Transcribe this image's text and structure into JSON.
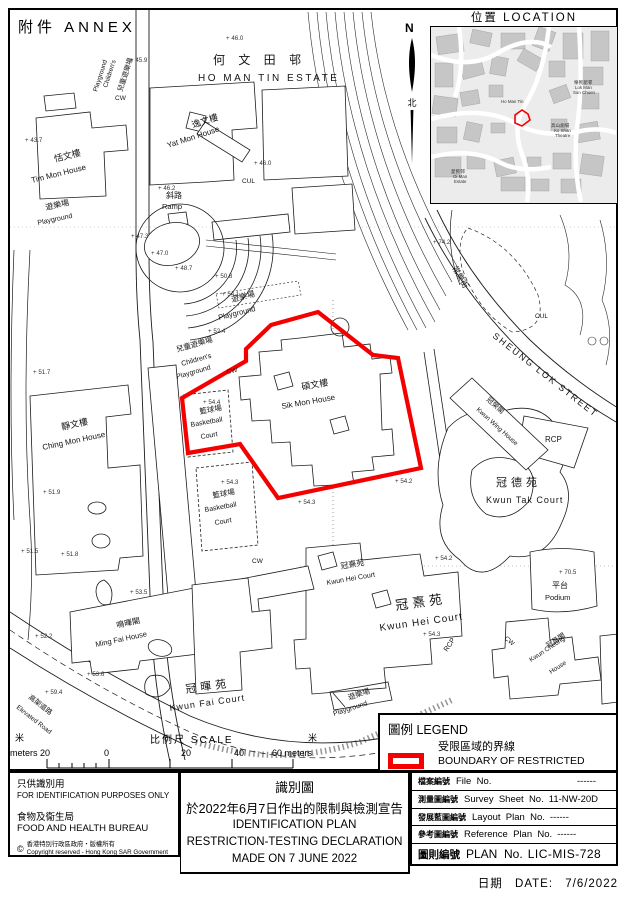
{
  "annex_label": "附件  ANNEX",
  "north": {
    "n": "N",
    "zh": "北"
  },
  "location_inset": {
    "title": "位置  LOCATION",
    "labels": [
      {
        "t": "樂民新邨",
        "x": 143,
        "y": 57,
        "s": 4.6
      },
      {
        "t": "Lok Man",
        "x": 144,
        "y": 62,
        "s": 4.4
      },
      {
        "t": "Sun Chuen",
        "x": 142,
        "y": 67,
        "s": 4.4
      },
      {
        "t": "Ho Man Tin",
        "x": 70,
        "y": 76,
        "s": 4.4
      },
      {
        "t": "高山劇場",
        "x": 120,
        "y": 100,
        "s": 4.6
      },
      {
        "t": "Ko Shan",
        "x": 123,
        "y": 105,
        "s": 4.4
      },
      {
        "t": "Theatre",
        "x": 124,
        "y": 110,
        "s": 4.4
      },
      {
        "t": "愛民邨",
        "x": 20,
        "y": 146,
        "s": 4.6
      },
      {
        "t": "Oi Man",
        "x": 22,
        "y": 151,
        "s": 4.4
      },
      {
        "t": "Estate",
        "x": 23,
        "y": 156,
        "s": 4.4
      }
    ]
  },
  "map": {
    "labels": [
      {
        "t": "何 文 田 邨",
        "x": 213,
        "y": 64,
        "s": 12,
        "ls": 5
      },
      {
        "t": "HO MAN TIN ESTATE",
        "x": 198,
        "y": 81,
        "s": 10,
        "ls": 2.5
      },
      {
        "t": "兒童遊樂場",
        "x": 122,
        "y": 92,
        "r": -72,
        "s": 7
      },
      {
        "t": "Children's",
        "x": 107,
        "y": 88,
        "r": -72,
        "s": 6.5
      },
      {
        "t": "Playground",
        "x": 97,
        "y": 92,
        "r": -72,
        "s": 6.5
      },
      {
        "t": "逸文樓",
        "x": 193,
        "y": 128,
        "r": -18,
        "s": 9
      },
      {
        "t": "Yat Mon House",
        "x": 168,
        "y": 148,
        "r": -18,
        "s": 8
      },
      {
        "t": "恬文樓",
        "x": 55,
        "y": 162,
        "r": -14,
        "s": 9
      },
      {
        "t": "Tim Mon House",
        "x": 32,
        "y": 183,
        "r": -14,
        "s": 8
      },
      {
        "t": "斜路",
        "x": 166,
        "y": 198,
        "s": 8
      },
      {
        "t": "Ramp",
        "x": 162,
        "y": 209,
        "s": 7.5
      },
      {
        "t": "遊樂場",
        "x": 46,
        "y": 210,
        "r": -12,
        "s": 8
      },
      {
        "t": "Playground",
        "x": 38,
        "y": 225,
        "r": -12,
        "s": 7
      },
      {
        "t": "遊樂場",
        "x": 232,
        "y": 302,
        "r": -14,
        "s": 8
      },
      {
        "t": "Playground",
        "x": 219,
        "y": 320,
        "r": -14,
        "s": 7.5
      },
      {
        "t": "兒童遊樂場",
        "x": 177,
        "y": 352,
        "r": -16,
        "s": 7.5
      },
      {
        "t": "Children's",
        "x": 182,
        "y": 366,
        "r": -16,
        "s": 7
      },
      {
        "t": "Playground",
        "x": 177,
        "y": 379,
        "r": -16,
        "s": 7
      },
      {
        "t": "碩文樓",
        "x": 302,
        "y": 390,
        "r": -10,
        "s": 9
      },
      {
        "t": "Sik Mon House",
        "x": 282,
        "y": 409,
        "r": -10,
        "s": 8
      },
      {
        "t": "籃球場",
        "x": 200,
        "y": 414,
        "r": -10,
        "s": 7.5
      },
      {
        "t": "Basketball",
        "x": 191,
        "y": 427,
        "r": -10,
        "s": 7
      },
      {
        "t": "Court",
        "x": 201,
        "y": 439,
        "r": -10,
        "s": 7
      },
      {
        "t": "籃球場",
        "x": 213,
        "y": 498,
        "r": -10,
        "s": 7.5
      },
      {
        "t": "Basketball",
        "x": 205,
        "y": 512,
        "r": -10,
        "s": 7
      },
      {
        "t": "Court",
        "x": 215,
        "y": 525,
        "r": -10,
        "s": 7
      },
      {
        "t": "靜文樓",
        "x": 62,
        "y": 430,
        "r": -12,
        "s": 9
      },
      {
        "t": "Ching Mon House",
        "x": 43,
        "y": 450,
        "r": -12,
        "s": 8
      },
      {
        "t": "常樂街",
        "x": 452,
        "y": 268,
        "r": 60,
        "s": 8
      },
      {
        "t": "SHEUNG  LOK  STREET",
        "x": 492,
        "y": 337,
        "r": 38,
        "s": 9,
        "ls": 2
      },
      {
        "t": "冠榮閣",
        "x": 486,
        "y": 400,
        "r": 42,
        "s": 7
      },
      {
        "t": "Kwun Wing House",
        "x": 476,
        "y": 410,
        "r": 42,
        "s": 6.5
      },
      {
        "t": "RCP",
        "x": 545,
        "y": 442,
        "s": 8
      },
      {
        "t": "冠德苑",
        "x": 496,
        "y": 486,
        "s": 11,
        "ls": 4
      },
      {
        "t": "Kwun  Tak  Court",
        "x": 486,
        "y": 503,
        "s": 9,
        "ls": 1
      },
      {
        "t": "平台",
        "x": 552,
        "y": 588,
        "s": 8
      },
      {
        "t": "Podium",
        "x": 545,
        "y": 600,
        "s": 7.5
      },
      {
        "t": "冠熹苑",
        "x": 341,
        "y": 569,
        "r": -10,
        "s": 8
      },
      {
        "t": "Kwun Hei Court",
        "x": 327,
        "y": 585,
        "r": -10,
        "s": 7
      },
      {
        "t": "冠熹苑",
        "x": 396,
        "y": 610,
        "r": -8,
        "s": 13,
        "ls": 4
      },
      {
        "t": "Kwun  Hei  Court",
        "x": 380,
        "y": 631,
        "r": -8,
        "s": 10,
        "ls": 1
      },
      {
        "t": "RCP",
        "x": 447,
        "y": 652,
        "r": -55,
        "s": 7
      },
      {
        "t": "冠昌閣",
        "x": 548,
        "y": 648,
        "r": -33,
        "s": 7
      },
      {
        "t": "Kwun Cheong",
        "x": 531,
        "y": 662,
        "r": -33,
        "s": 6.5
      },
      {
        "t": "House",
        "x": 551,
        "y": 674,
        "r": -33,
        "s": 6.5
      },
      {
        "t": "鳴暉閣",
        "x": 117,
        "y": 628,
        "r": -12,
        "s": 8
      },
      {
        "t": "Ming Fai House",
        "x": 96,
        "y": 647,
        "r": -12,
        "s": 7.5
      },
      {
        "t": "冠暉苑",
        "x": 186,
        "y": 693,
        "r": -8,
        "s": 11,
        "ls": 4
      },
      {
        "t": "Kwun  Fai  Court",
        "x": 170,
        "y": 711,
        "r": -8,
        "s": 9,
        "ls": 1
      },
      {
        "t": "高架道路",
        "x": 28,
        "y": 698,
        "r": 38,
        "s": 7
      },
      {
        "t": "Elevated Road",
        "x": 16,
        "y": 708,
        "r": 38,
        "s": 6.5
      },
      {
        "t": "遊樂場",
        "x": 349,
        "y": 700,
        "r": -18,
        "s": 7.5
      },
      {
        "t": "Playground",
        "x": 334,
        "y": 716,
        "r": -18,
        "s": 7
      },
      {
        "t": "CW",
        "x": 115,
        "y": 100,
        "s": 6.5
      },
      {
        "t": "CUL",
        "x": 242,
        "y": 183,
        "s": 6.5
      },
      {
        "t": "CW",
        "x": 227,
        "y": 374,
        "r": -12,
        "s": 6.5
      },
      {
        "t": "CUL",
        "x": 535,
        "y": 318,
        "s": 6.5
      },
      {
        "t": "CW",
        "x": 504,
        "y": 639,
        "r": 40,
        "s": 6.5
      },
      {
        "t": "CW",
        "x": 252,
        "y": 563,
        "s": 6.5
      }
    ],
    "spot_heights": [
      {
        "v": "46.0",
        "x": 226,
        "y": 40
      },
      {
        "v": "45.9",
        "x": 130,
        "y": 62
      },
      {
        "v": "43.7",
        "x": 25,
        "y": 142
      },
      {
        "v": "46.0",
        "x": 254,
        "y": 165
      },
      {
        "v": "46.2",
        "x": 158,
        "y": 190
      },
      {
        "v": "47.3",
        "x": 131,
        "y": 238
      },
      {
        "v": "47.0",
        "x": 151,
        "y": 255
      },
      {
        "v": "48.7",
        "x": 175,
        "y": 270
      },
      {
        "v": "50.8",
        "x": 215,
        "y": 278
      },
      {
        "v": "54.1",
        "x": 222,
        "y": 296
      },
      {
        "v": "52.4",
        "x": 208,
        "y": 333
      },
      {
        "v": "51.7",
        "x": 33,
        "y": 374
      },
      {
        "v": "54.4",
        "x": 203,
        "y": 404
      },
      {
        "v": "51.9",
        "x": 43,
        "y": 494
      },
      {
        "v": "54.3",
        "x": 221,
        "y": 484
      },
      {
        "v": "54.3",
        "x": 298,
        "y": 504
      },
      {
        "v": "54.2",
        "x": 395,
        "y": 483
      },
      {
        "v": "51.5",
        "x": 21,
        "y": 553
      },
      {
        "v": "51.8",
        "x": 61,
        "y": 556
      },
      {
        "v": "54.2",
        "x": 435,
        "y": 560
      },
      {
        "v": "54.3",
        "x": 423,
        "y": 636
      },
      {
        "v": "53.5",
        "x": 130,
        "y": 594
      },
      {
        "v": "52.2",
        "x": 35,
        "y": 638
      },
      {
        "v": "53.6",
        "x": 87,
        "y": 676
      },
      {
        "v": "59.4",
        "x": 45,
        "y": 694
      },
      {
        "v": "74.2",
        "x": 433,
        "y": 244
      },
      {
        "v": "70.5",
        "x": 559,
        "y": 574
      }
    ]
  },
  "scale": {
    "m_left": "米",
    "meters_left": "meters 20",
    "zero": "0",
    "title": "比例尺  SCALE",
    "t20": "20",
    "t40": "40",
    "t60": "60 meters",
    "m_right": "米"
  },
  "legend": {
    "title": "圖例 LEGEND",
    "item_zh": "受限區域的界線",
    "item_en": "BOUNDARY OF RESTRICTED AREA"
  },
  "footer": {
    "left": {
      "line1_zh": "只供識別用",
      "line1_en": "FOR IDENTIFICATION PURPOSES ONLY",
      "org_zh": "食物及衞生局",
      "org_en": "FOOD AND HEALTH BUREAU",
      "copy_sym": "©",
      "copy_zh": "香港特別行政區政府‧版權所有",
      "copy_en": "Copyright reserved - Hong Kong SAR Government"
    },
    "center": {
      "title_zh": "識別圖",
      "subtitle_zh": "於2022年6月7日作出的限制與檢測宣告",
      "line1": "IDENTIFICATION PLAN",
      "line2": "RESTRICTION-TESTING DECLARATION",
      "line3": "MADE ON 7 JUNE 2022"
    }
  },
  "info_table": {
    "rows": [
      {
        "zh": "檔案編號",
        "en": "File  No.",
        "value": "------",
        "right": true
      },
      {
        "zh": "測量圖編號",
        "en": "Survey  Sheet  No.",
        "value": "11-NW-20D"
      },
      {
        "zh": "發展藍圖編號",
        "en": "Layout  Plan  No.",
        "value": "------"
      },
      {
        "zh": "參考圖編號",
        "en": "Reference  Plan  No.",
        "value": "------"
      },
      {
        "zh": "圖則編號",
        "en": "PLAN  No.",
        "value": "LIC-MIS-728",
        "big": true
      }
    ]
  },
  "date_line": {
    "zh": "日期",
    "en": "DATE:",
    "value": "7/6/2022"
  },
  "colors": {
    "boundary_red": "#f40000",
    "map_line": "#1c1c1c"
  }
}
